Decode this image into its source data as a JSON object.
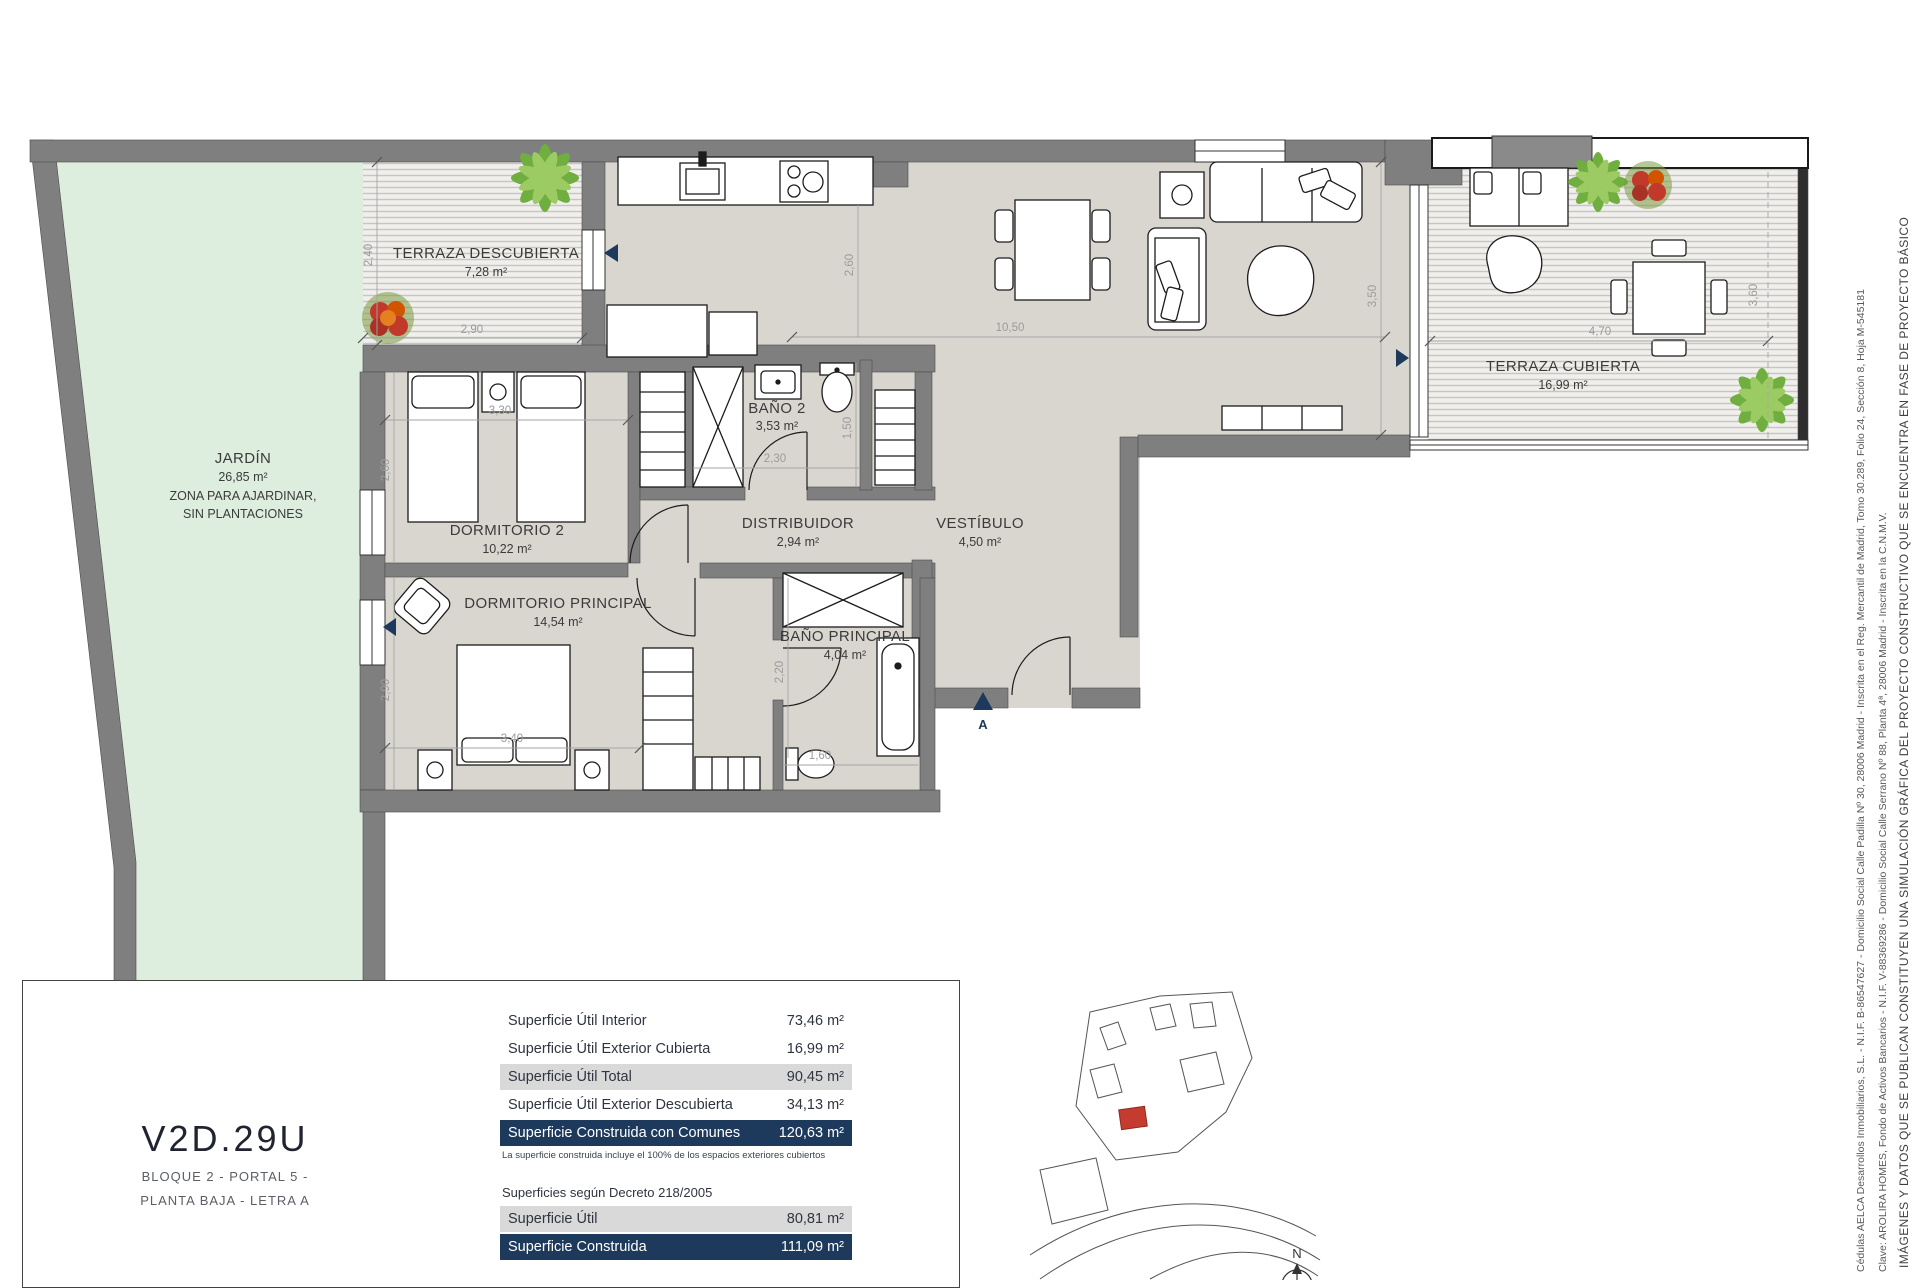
{
  "unit": {
    "code": "V2D.29U",
    "block": "BLOQUE 2 - PORTAL 5 -",
    "floor": "PLANTA BAJA - LETRA A"
  },
  "rooms": {
    "terraza_descubierta": {
      "name": "TERRAZA DESCUBIERTA",
      "area": "7,28 m²"
    },
    "jardin": {
      "name": "JARDÍN",
      "area": "26,85 m²",
      "note1": "ZONA PARA AJARDINAR,",
      "note2": "SIN PLANTACIONES"
    },
    "dormitorio2": {
      "name": "DORMITORIO 2",
      "area": "10,22 m²"
    },
    "bano2": {
      "name": "BAÑO 2",
      "area": "3,53 m²"
    },
    "distribuidor": {
      "name": "DISTRIBUIDOR",
      "area": "2,94 m²"
    },
    "vestibulo": {
      "name": "VESTÍBULO",
      "area": "4,50 m²"
    },
    "dormitorio_principal": {
      "name": "DORMITORIO PRINCIPAL",
      "area": "14,54 m²"
    },
    "bano_principal": {
      "name": "BAÑO PRINCIPAL",
      "area": "4,04 m²"
    },
    "terraza_cubierta": {
      "name": "TERRAZA CUBIERTA",
      "area": "16,99 m²"
    }
  },
  "dims": {
    "td_w": "2,90",
    "td_h": "2,40",
    "d2_w": "3,30",
    "d2_h": "2,60",
    "kit_h": "2,60",
    "salon_w": "10,50",
    "salon_h": "3,50",
    "dp_w": "3,40",
    "dp_h": "2,90",
    "bp_h": "2,20",
    "bp_w": "1,60",
    "b2_w": "2,30",
    "b2_h": "1,50",
    "tc_w": "4,70",
    "tc_h": "3,60"
  },
  "markers": {
    "entrance": "A",
    "north": "N"
  },
  "scale": {
    "t0": "0",
    "t1": "1",
    "t2": "2",
    "t3": "3",
    "label": "Escala en metros"
  },
  "areas_table": {
    "rows": [
      {
        "label": "Superficie Útil Interior",
        "value": "73,46 m²"
      },
      {
        "label": "Superficie Útil Exterior Cubierta",
        "value": "16,99 m²"
      },
      {
        "label": "Superficie Útil Total",
        "value": "90,45 m²"
      },
      {
        "label": "Superficie Útil Exterior Descubierta",
        "value": "34,13 m²"
      },
      {
        "label": "Superficie Construida con Comunes",
        "value": "120,63 m²"
      }
    ],
    "note": "La superficie construida incluye el 100% de los espacios exteriores cubiertos",
    "decree_heading": "Superficies según Decreto 218/2005",
    "decree_rows": [
      {
        "label": "Superficie Útil",
        "value": "80,81 m²"
      },
      {
        "label": "Superficie Construida",
        "value": "111,09 m²"
      }
    ]
  },
  "disclaimers": {
    "line1": "IMÁGENES Y DATOS QUE SE PUBLICAN CONSTITUYEN UNA SIMULACIÓN GRÁFICA DEL PROYECTO CONSTRUCTIVO QUE SE ENCUENTRA EN FASE DE PROYECTO BÁSICO",
    "line2": "Clave: AROLIRA HOMES, Fondo de Activos Bancarios - N.I.F. V-88369286 - Domicilio Social Calle Serrano Nº 88, Planta 4ª, 28006 Madrid - Inscrita en la C.N.M.V.",
    "line3": "Cédulas AELCA Desarrollos Inmobiliarios, S.L. - N.I.F. B-86547627 - Domicilio Social Calle Padilla Nº 30, 28006 Madrid - Inscrita en el Reg. Mercantil de Madrid, Tomo 30.289, Folio 24, Sección 8, Hoja M-545181"
  },
  "colors": {
    "navy": "#1d3a5c",
    "wall": "#7f7f7f",
    "garden": "#deeede",
    "floor": "#d9d6d0",
    "unit_red": "#c63b2f"
  }
}
